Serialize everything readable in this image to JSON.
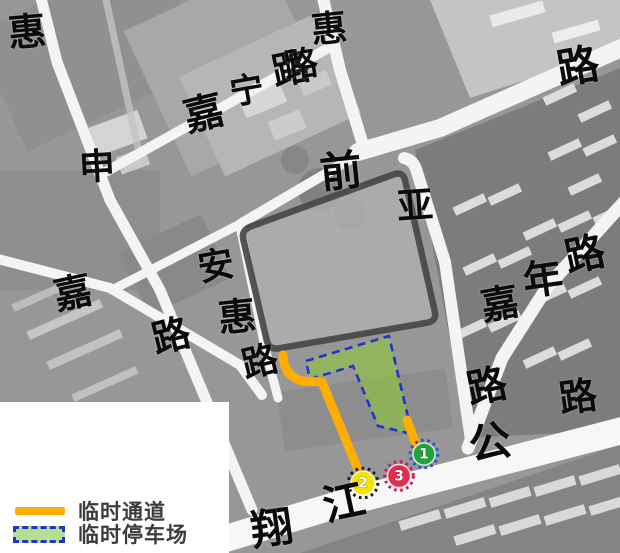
{
  "map": {
    "legend": {
      "items": [
        {
          "type": "line",
          "label": "临时通道"
        },
        {
          "type": "area",
          "label": "临时停车场"
        }
      ]
    },
    "road_name_labels": [
      {
        "text": "惠",
        "road": "west-road",
        "x": 27,
        "y": 32,
        "size": 38,
        "rot": -5
      },
      {
        "text": "申",
        "road": "west-road",
        "x": 97,
        "y": 167,
        "size": 36,
        "rot": -3
      },
      {
        "text": "嘉",
        "road": "jianing-road",
        "x": 204,
        "y": 114,
        "size": 40,
        "rot": -14
      },
      {
        "text": "宁",
        "road": "jianing-road",
        "x": 247,
        "y": 91,
        "size": 34,
        "rot": -10
      },
      {
        "text": "路",
        "road": "jianing-road",
        "x": 291,
        "y": 69,
        "size": 38,
        "rot": -12
      },
      {
        "text": "惠",
        "road": "north-road",
        "x": 329,
        "y": 29,
        "size": 36,
        "rot": -6
      },
      {
        "text": "路",
        "road": "north-road",
        "x": 301,
        "y": 65,
        "size": 34,
        "rot": -8
      },
      {
        "text": "路",
        "road": "northeast-road",
        "x": 578,
        "y": 67,
        "size": 42,
        "rot": -10
      },
      {
        "text": "前",
        "road": "site-north-road",
        "x": 341,
        "y": 172,
        "size": 42,
        "rot": -6
      },
      {
        "text": "亚",
        "road": "site-north-road",
        "x": 415,
        "y": 206,
        "size": 36,
        "rot": -4
      },
      {
        "text": "安",
        "road": "anhui-road",
        "x": 216,
        "y": 266,
        "size": 36,
        "rot": -10
      },
      {
        "text": "惠",
        "road": "anhui-road",
        "x": 237,
        "y": 317,
        "size": 38,
        "rot": -6
      },
      {
        "text": "路",
        "road": "anhui-road",
        "x": 260,
        "y": 362,
        "size": 36,
        "rot": -14
      },
      {
        "text": "嘉",
        "road": "west-mid-road",
        "x": 73,
        "y": 293,
        "size": 38,
        "rot": -12
      },
      {
        "text": "路",
        "road": "west-mid-road",
        "x": 171,
        "y": 336,
        "size": 38,
        "rot": -14
      },
      {
        "text": "嘉",
        "road": "jianian-road",
        "x": 500,
        "y": 304,
        "size": 38,
        "rot": -10
      },
      {
        "text": "年",
        "road": "jianian-road",
        "x": 543,
        "y": 280,
        "size": 40,
        "rot": -8
      },
      {
        "text": "路",
        "road": "jianian-road",
        "x": 585,
        "y": 255,
        "size": 40,
        "rot": -12
      },
      {
        "text": "路",
        "road": "site-east-road",
        "x": 487,
        "y": 387,
        "size": 40,
        "rot": -12
      },
      {
        "text": "翔",
        "road": "xiangjiang-highway",
        "x": 272,
        "y": 529,
        "size": 42,
        "rot": -8
      },
      {
        "text": "江",
        "road": "xiangjiang-highway",
        "x": 344,
        "y": 503,
        "size": 42,
        "rot": -12
      },
      {
        "text": "公",
        "road": "xiangjiang-highway",
        "x": 490,
        "y": 443,
        "size": 42,
        "rot": -10
      },
      {
        "text": "路",
        "road": "xiangjiang-highway",
        "x": 578,
        "y": 397,
        "size": 38,
        "rot": -8
      }
    ],
    "markers": [
      {
        "number": "1",
        "x": 424,
        "y": 454,
        "r": 11,
        "fill": "#1FA33C",
        "ring": "#1E56C8"
      },
      {
        "number": "2",
        "x": 363,
        "y": 483,
        "r": 12,
        "fill": "#F6E300",
        "ring": "#1B1B1B"
      },
      {
        "number": "3",
        "x": 399,
        "y": 476,
        "r": 11.5,
        "fill": "#E62B4F",
        "ring": "#C11868"
      }
    ],
    "colors": {
      "passage_orange": "#FFAD00",
      "parking_fill": "#8CC63F",
      "parking_border": "#2433C9",
      "site_border": "#474747",
      "legend_text": "#3C3C3C"
    }
  }
}
